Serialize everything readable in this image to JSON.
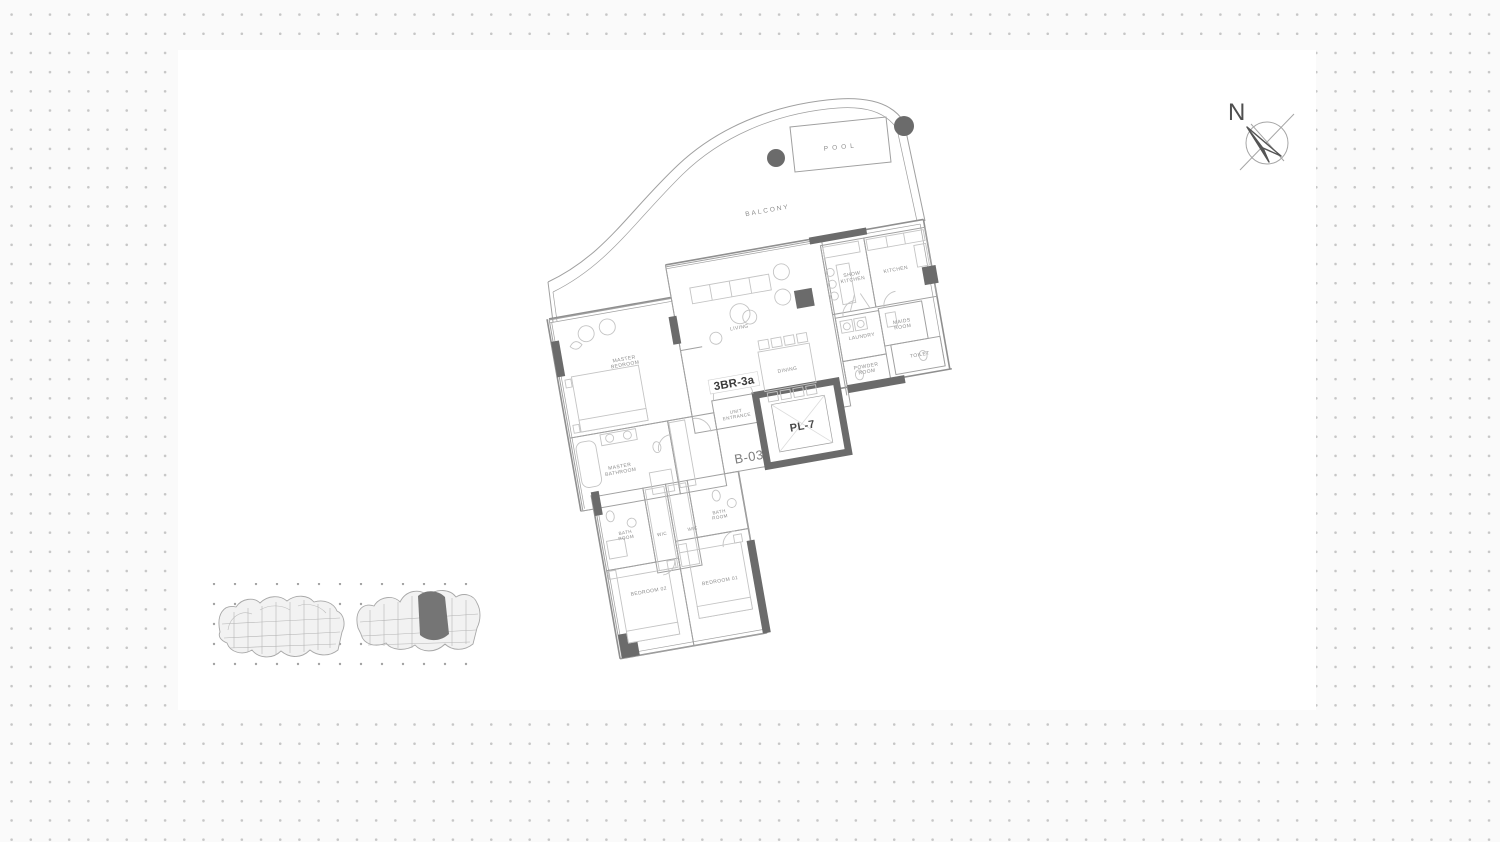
{
  "canvas": {
    "background": "#fafafa",
    "dot_color": "#c6c6c6",
    "paper_color": "#ffffff",
    "line_color": "#a0a0a0",
    "furniture_color": "#c4c4c4",
    "structure_color": "#6b6b6b",
    "label_color": "#8c8c8c",
    "label_dark_color": "#3b3b3b",
    "site_highlight_color": "#757575"
  },
  "compass": {
    "north_label": "N"
  },
  "floor_plan": {
    "unit_type": "3BR-3a",
    "unit_number": "B-03",
    "lift": "PL-7",
    "entrance": "UNIT ENTRANCE",
    "outdoor": {
      "pool": "POOL",
      "balcony": "BALCONY"
    },
    "rooms": {
      "master_bedroom": "MASTER BEDROOM",
      "master_bathroom": "MASTER BATHROOM",
      "living": "LIVING",
      "dining": "DINING",
      "show_kitchen": "SHOW KITCHEN",
      "kitchen": "KITCHEN",
      "laundry": "LAUNDRY",
      "maids_room": "MAIDS ROOM",
      "powder_room": "POWDER ROOM",
      "toilet": "TOILET",
      "bathroom_2": "BATH ROOM",
      "wic_2": "WIC",
      "bathroom_1": "BATH ROOM",
      "wic_1": "WIC",
      "bedroom_02": "BEDROOM 02",
      "bedroom_01": "BEDROOM 01"
    }
  }
}
